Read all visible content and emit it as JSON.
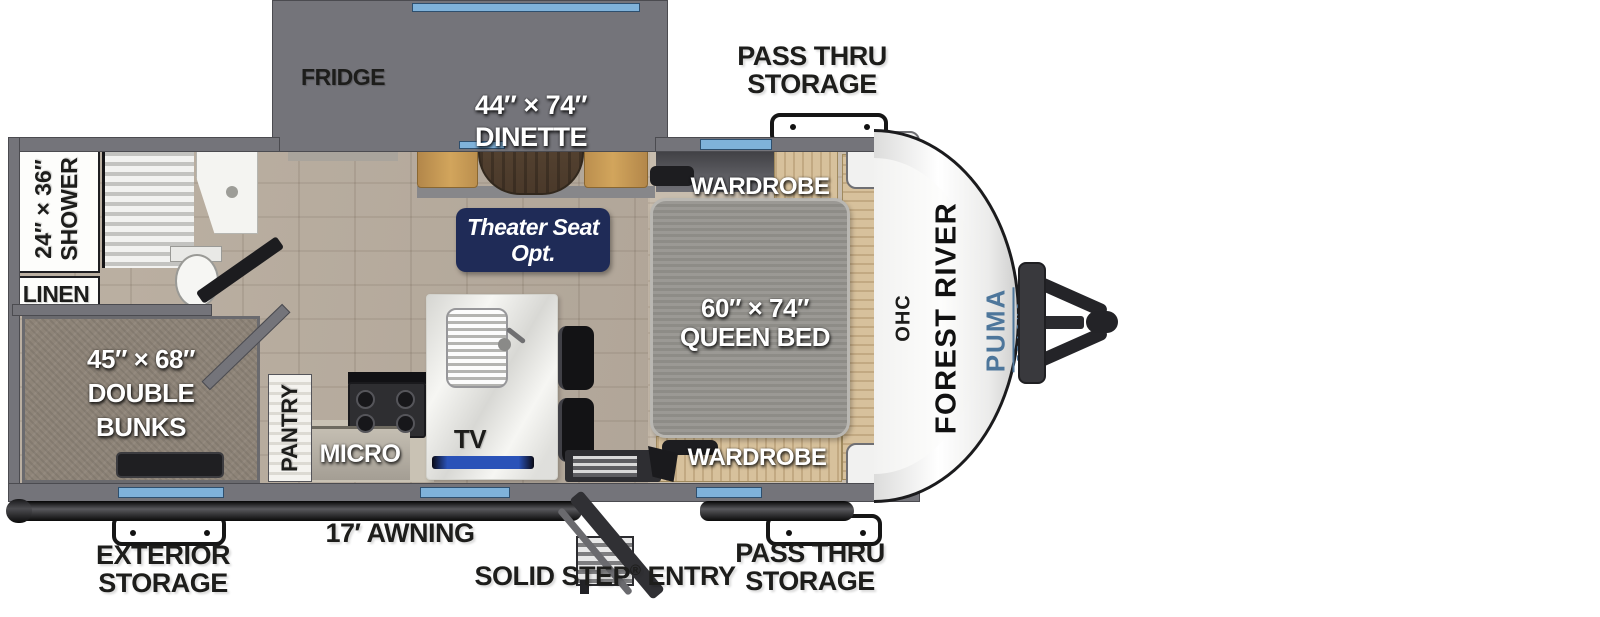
{
  "colors": {
    "wall": "#74747a",
    "wall_dark": "#4b4b50",
    "window_blue": "#7fb2da",
    "navy": "#1f2b57",
    "puma_blue": "#4d769b",
    "bench": "#c79a50",
    "wood": "#d7c19c",
    "trim_black": "#1b1b1d",
    "text_black": "#1d1d1b",
    "mattress": "#95938e",
    "bunk": "#8e8478"
  },
  "rooms": {
    "fridge": "FRIDGE",
    "dinette_size": "44″ × 74″",
    "dinette_name": "DINETTE",
    "wardrobe_top": "WARDROBE",
    "wardrobe_bottom": "WARDROBE",
    "shower_size": "24″ × 36″",
    "shower_name": "SHOWER",
    "linen": "LINEN",
    "theater_line1": "Theater Seat",
    "theater_line2": "Opt.",
    "queen_size": "60″ × 74″",
    "queen_name": "QUEEN BED",
    "ohc": "OHC",
    "bunks_size": "45″ × 68″",
    "bunks_line2": "DOUBLE",
    "bunks_line3": "BUNKS",
    "pantry": "PANTRY",
    "micro": "MICRO",
    "tv": "TV"
  },
  "exterior": {
    "pass_thru_top_line1": "PASS THRU",
    "pass_thru_top_line2": "STORAGE",
    "pass_thru_bottom_line1": "PASS THRU",
    "pass_thru_bottom_line2": "STORAGE",
    "exterior_storage_line1": "EXTERIOR",
    "exterior_storage_line2": "STORAGE",
    "awning": "17′ AWNING",
    "solid_step": {
      "pre": "SOLID STEP",
      "reg": "®",
      "post": "ENTRY"
    }
  },
  "brand": {
    "manufacturer": "FOREST RIVER",
    "model": "PUMA",
    "submodel": "TRACKS"
  }
}
